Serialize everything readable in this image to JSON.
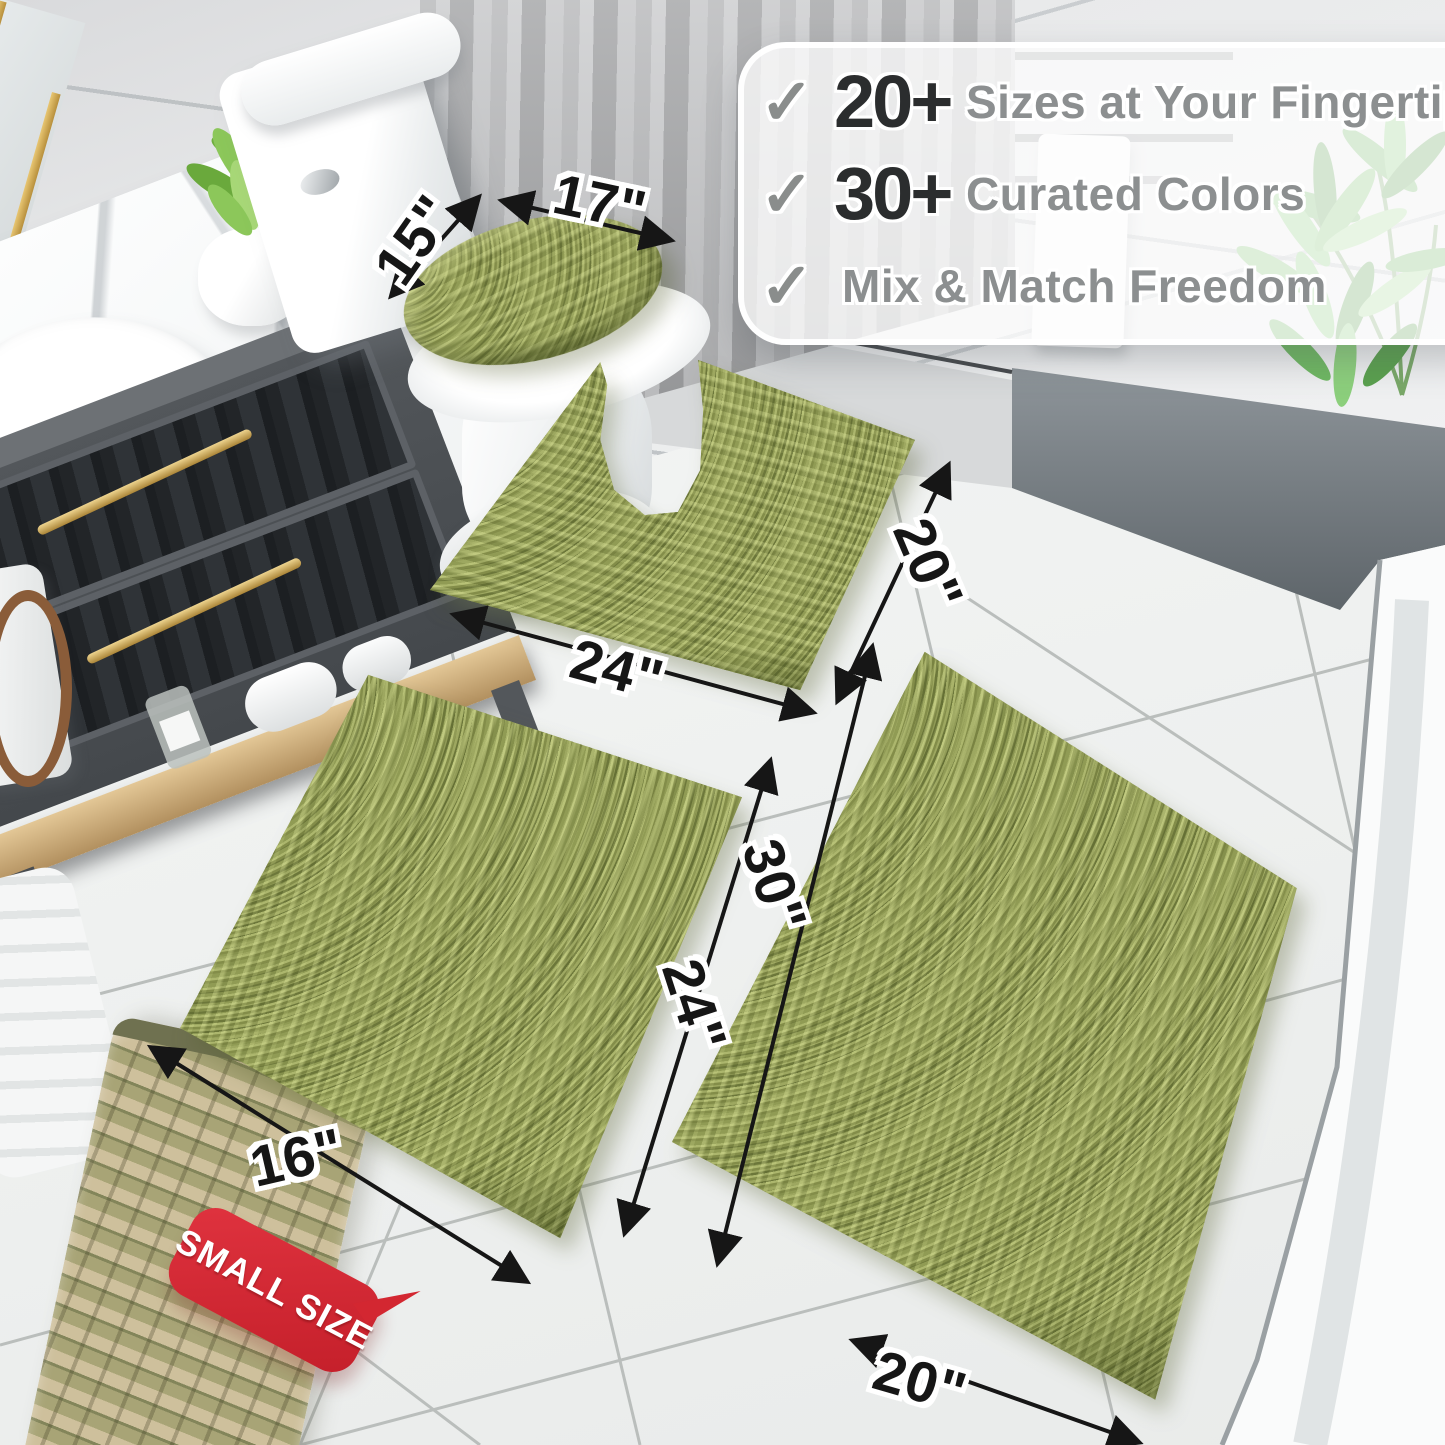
{
  "panel": {
    "check_icon": "✓",
    "items": [
      {
        "stat": "20+",
        "label": "Sizes at Your Fingertips"
      },
      {
        "stat": "30+",
        "label": "Curated Colors"
      },
      {
        "label": "Mix & Match Freedom"
      }
    ]
  },
  "dimensions": {
    "lid": {
      "width": "17\"",
      "depth": "15\""
    },
    "contour": {
      "width": "24\"",
      "depth": "20\""
    },
    "small": {
      "width": "16\"",
      "length": "24\""
    },
    "large": {
      "width": "20\"",
      "length": "30\""
    }
  },
  "badge": {
    "text": "SMALL SIZE"
  },
  "colors": {
    "rug_green": "#95a058",
    "badge_red": "#d32731",
    "stat_text": "#2b2d2e",
    "panel_label_text": "#8c8f90",
    "arrow_black": "#161616"
  }
}
